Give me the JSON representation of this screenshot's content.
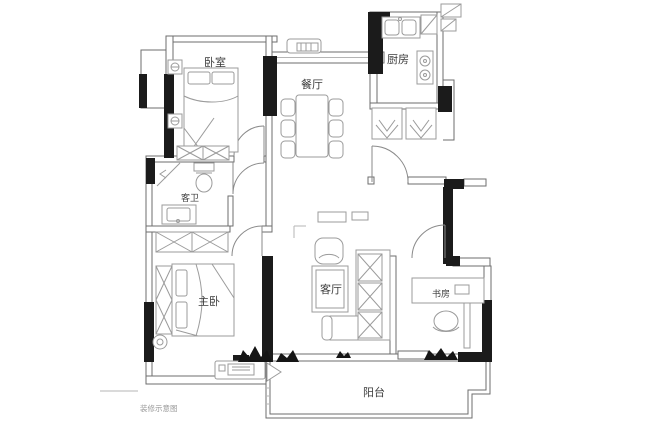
{
  "caption": {
    "text": "装修示意图"
  },
  "colors": {
    "background": "#ffffff",
    "wall_line": "#6e6e6e",
    "wall_fill": "#ffffff",
    "structure_fill": "#1b1b1b",
    "furniture_line": "#9b9b9b",
    "door_line": "#8a8a8a",
    "label_color": "#3c3c3c",
    "caption_color": "#9a9a9a"
  },
  "rooms": [
    {
      "id": "bedroom",
      "label": "卧室"
    },
    {
      "id": "dining-room",
      "label": "餐厅"
    },
    {
      "id": "kitchen",
      "label": "厨房"
    },
    {
      "id": "guest-bathroom",
      "label": "客卫"
    },
    {
      "id": "master-bedroom",
      "label": "主卧"
    },
    {
      "id": "living-room",
      "label": "客厅"
    },
    {
      "id": "study",
      "label": "书房"
    },
    {
      "id": "balcony",
      "label": "阳台"
    }
  ]
}
